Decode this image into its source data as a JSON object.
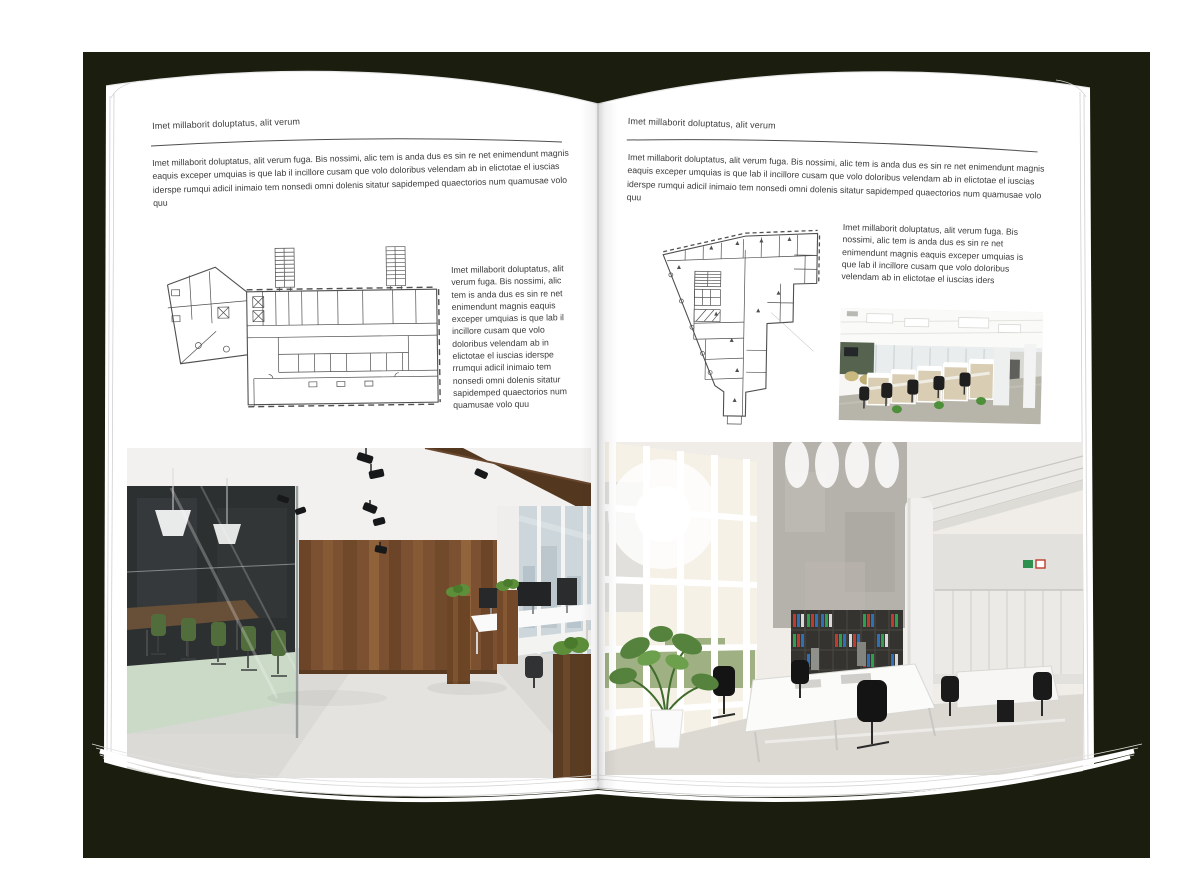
{
  "spread": {
    "left_page": {
      "header": "Imet millaborit doluptatus, alit verum",
      "intro": "Imet millaborit doluptatus, alit verum fuga. Bis nossimi, alic tem is anda dus es sin re net enimendunt magnis eaquis exceper umquias is que lab il incillore cusam que volo doloribus velendam ab in elictotae el iuscias iderspe rumqui adicil inimaio tem nonsedi omni dolenis sitatur sapidemped quaectorios num quamusae volo quu",
      "caption": "Imet millaborit doluptatus, alit verum fuga. Bis nossimi, alic tem is anda dus es sin re net enimendunt magnis eaquis exceper umquias is que lab il incillore cusam que volo doloribus velendam ab in elictotae el iuscias iderspe rrumqui adicil inimaio tem nonsedi omni dolenis sitatur sapidemped quaectorios num quamusae volo quu"
    },
    "right_page": {
      "header": "Imet millaborit doluptatus, alit verum",
      "intro": "Imet millaborit doluptatus, alit verum fuga. Bis nossimi, alic tem is anda dus es sin re net enimendunt magnis eaquis exceper umquias is que lab il incillore cusam que volo doloribus velendam ab in elictotae el iuscias iderspe rumqui adicil inimaio tem nonsedi omni dolenis sitatur sapidemped quaectorios num quamusae volo quu",
      "caption": "Imet millaborit doluptatus, alit verum fuga. Bis nossimi, alic tem is anda dus es sin re net enimendunt magnis eaquis exceper umquias is que lab il incillore cusam que volo doloribus velendam ab in elictotae el iuscias iders"
    }
  },
  "colors": {
    "backdrop": "#1b1d0e",
    "page": "#ffffff",
    "text": "#3c3c3c",
    "plan_line": "#4f4f4f"
  }
}
